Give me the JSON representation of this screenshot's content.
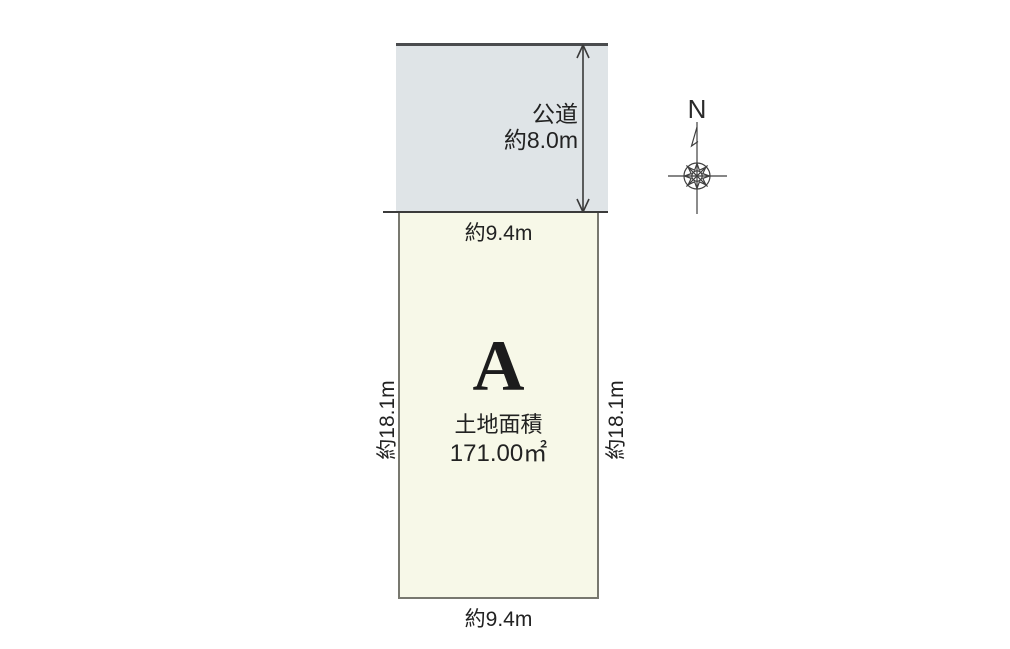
{
  "colors": {
    "road_fill": "#dfe4e7",
    "plot_fill": "#f7f8e8",
    "line": "#3b3b3b",
    "text": "#222222"
  },
  "road": {
    "name": "公道",
    "width": "約8.0m"
  },
  "plot": {
    "label": "A",
    "area_title": "土地面積",
    "area_value": "171.00㎡",
    "frontage_top": "約9.4m",
    "frontage_bottom": "約9.4m",
    "depth_left": "約18.1m",
    "depth_right": "約18.1m"
  },
  "compass": {
    "north": "N"
  }
}
